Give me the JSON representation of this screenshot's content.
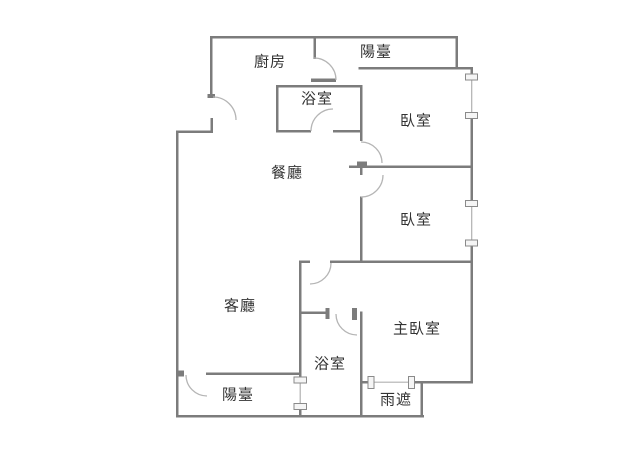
{
  "title": "apartment-floor-plan",
  "colors": {
    "background": "#ffffff",
    "wall": "#7c7c7c",
    "door_arc": "#b5b5b5",
    "window_line": "#b0b0b0",
    "window_fill": "#f5f5f5",
    "window_stroke": "#8a8a8a",
    "text": "#333333"
  },
  "rooms": [
    {
      "id": "kitchen",
      "label": "廚房"
    },
    {
      "id": "balcony-top",
      "label": "陽臺"
    },
    {
      "id": "bathroom-top",
      "label": "浴室"
    },
    {
      "id": "bedroom-1",
      "label": "臥室"
    },
    {
      "id": "dining-room",
      "label": "餐廳"
    },
    {
      "id": "bedroom-2",
      "label": "臥室"
    },
    {
      "id": "living-room",
      "label": "客廳"
    },
    {
      "id": "master-bedroom",
      "label": "主臥室"
    },
    {
      "id": "bathroom-bottom",
      "label": "浴室"
    },
    {
      "id": "balcony-bottom",
      "label": "陽臺"
    },
    {
      "id": "rain-shelter",
      "label": "雨遮"
    }
  ]
}
